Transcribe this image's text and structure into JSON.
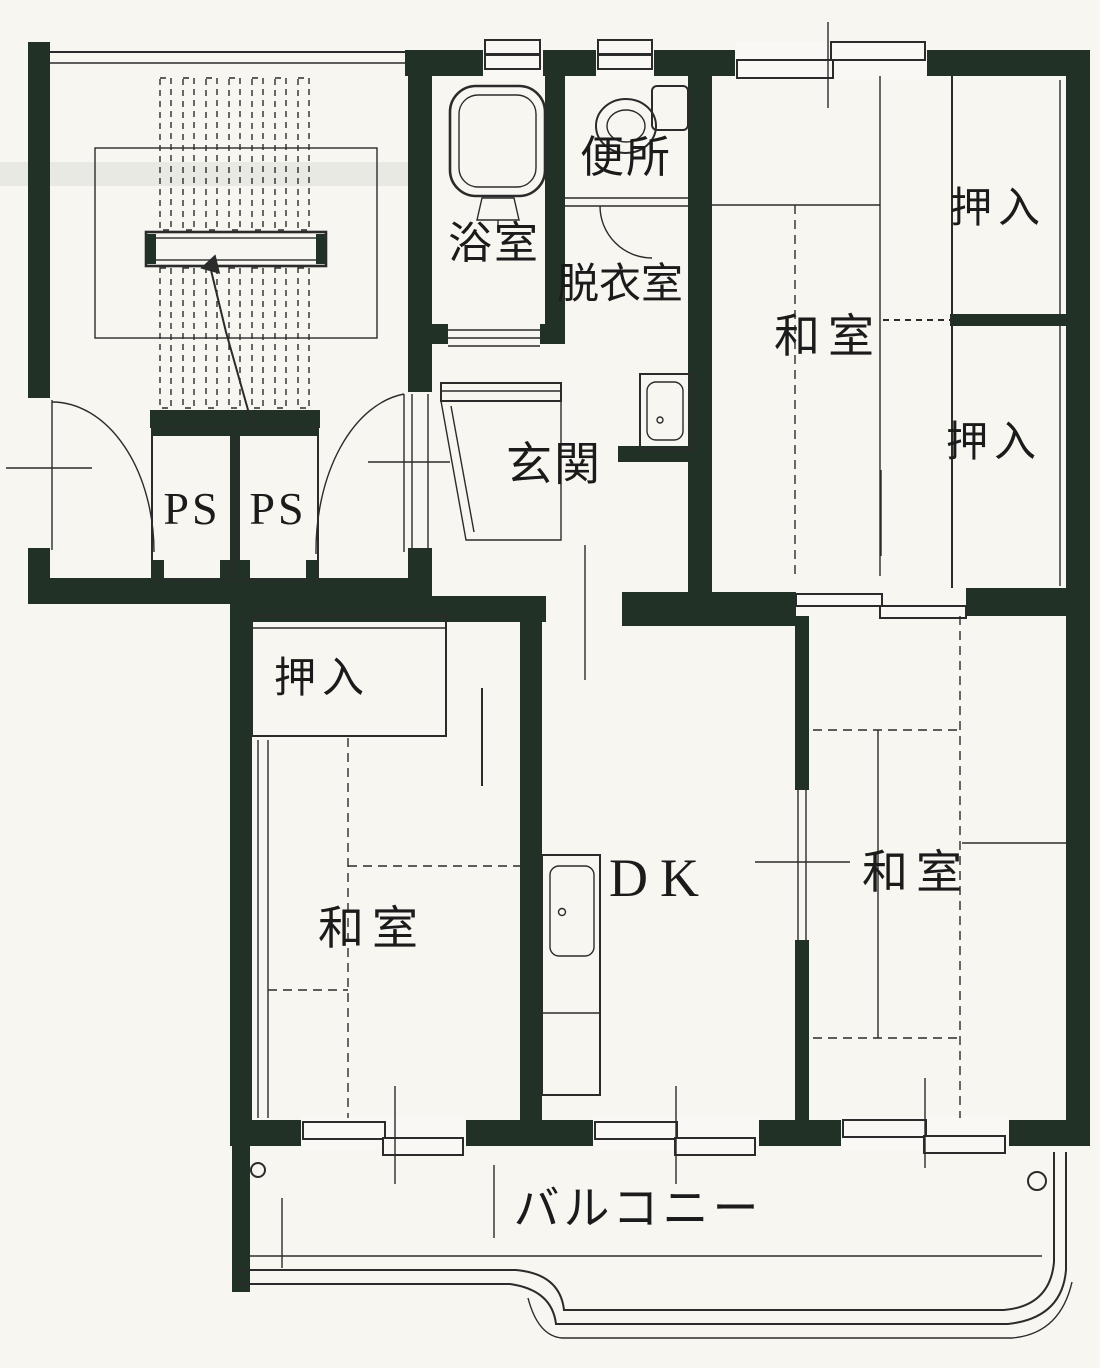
{
  "labels": {
    "bath": "浴室",
    "toilet": "便所",
    "dressing_room": "脱衣室",
    "entrance": "玄関",
    "ps_left": "PS",
    "ps_right": "PS",
    "washitsu_ne": "和室",
    "oshiire_ne_upper": "押入",
    "oshiire_ne_lower": "押入",
    "oshiire_sw": "押入",
    "washitsu_sw": "和室",
    "dk": "DK",
    "washitsu_se": "和室",
    "balcony": "バルコニー"
  },
  "colors": {
    "wall": "#213126",
    "line": "#2b2b2b",
    "paper": "#f7f6f1"
  }
}
